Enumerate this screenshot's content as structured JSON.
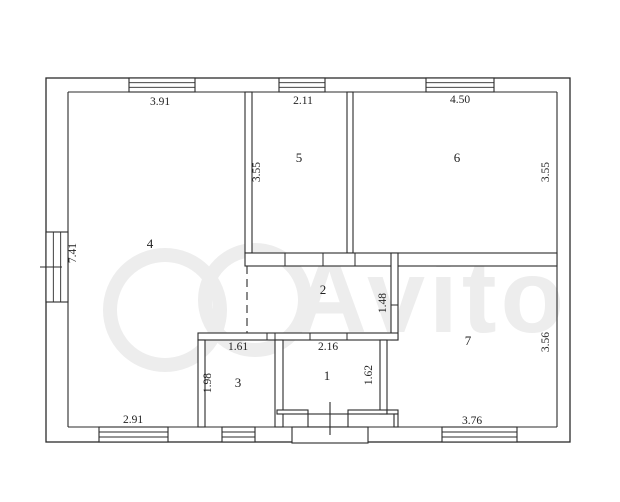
{
  "plan": {
    "canvas": {
      "width": 620,
      "height": 502
    },
    "colors": {
      "background": "#ffffff",
      "line": "#2b2b2b",
      "wall_fill": "#ffffff",
      "watermark": "#ededed"
    },
    "watermark": {
      "text": "Avito",
      "text_x": 430,
      "text_y": 332,
      "circles": [
        {
          "cx": 165,
          "cy": 310,
          "r": 55
        },
        {
          "cx": 255,
          "cy": 300,
          "r": 50
        }
      ]
    },
    "outer": {
      "x": 46,
      "y": 78,
      "w": 524,
      "h": 364,
      "inner": {
        "left": 68,
        "top": 92,
        "right": 557,
        "bottom": 427
      }
    },
    "interior_walls": [
      {
        "name": "wall-room4-room5",
        "x": 245,
        "y": 92,
        "w": 7,
        "h": 161
      },
      {
        "name": "wall-room5-room6",
        "x": 347,
        "y": 92,
        "w": 6,
        "h": 161
      },
      {
        "name": "wall-corridor-top",
        "x": 245,
        "y": 253,
        "w": 312,
        "h": 13
      },
      {
        "name": "wall-corridor-right",
        "x": 391,
        "y": 253,
        "w": 7,
        "h": 87
      },
      {
        "name": "wall-rooms31-top",
        "x": 198,
        "y": 333,
        "w": 200,
        "h": 7
      },
      {
        "name": "wall-room3-left",
        "x": 198,
        "y": 340,
        "w": 7,
        "h": 87
      },
      {
        "name": "wall-room3-room1",
        "x": 275,
        "y": 340,
        "w": 8,
        "h": 87
      },
      {
        "name": "wall-room1-right",
        "x": 380,
        "y": 340,
        "w": 7,
        "h": 74
      },
      {
        "name": "wall-room1-bottom-l",
        "x": 277,
        "y": 410,
        "w": 31,
        "h": 4
      },
      {
        "name": "wall-room1-bottom-r",
        "x": 348,
        "y": 410,
        "w": 39,
        "h": 4
      },
      {
        "name": "wall-step-h",
        "x": 387,
        "y": 410,
        "w": 11,
        "h": 4
      },
      {
        "name": "wall-step-v",
        "x": 394,
        "y": 414,
        "w": 4,
        "h": 13
      }
    ],
    "windows": [
      {
        "name": "window-top-room4",
        "orient": "h",
        "x": 129,
        "y": 78,
        "w": 66,
        "h": 14
      },
      {
        "name": "window-top-room5",
        "orient": "h",
        "x": 279,
        "y": 78,
        "w": 46,
        "h": 14
      },
      {
        "name": "window-top-room6",
        "orient": "h",
        "x": 426,
        "y": 78,
        "w": 68,
        "h": 14
      },
      {
        "name": "window-left-room4",
        "orient": "v",
        "x": 46,
        "y": 232,
        "w": 22,
        "h": 70
      },
      {
        "name": "window-bottom-room4",
        "orient": "h",
        "x": 99,
        "y": 427,
        "w": 69,
        "h": 15
      },
      {
        "name": "window-bottom-room3",
        "orient": "h",
        "x": 222,
        "y": 427,
        "w": 33,
        "h": 15
      },
      {
        "name": "window-bottom-room7",
        "orient": "h",
        "x": 442,
        "y": 427,
        "w": 75,
        "h": 15
      }
    ],
    "door_ticks": [
      {
        "x1": 285,
        "y1": 253,
        "x2": 285,
        "y2": 266
      },
      {
        "x1": 323,
        "y1": 253,
        "x2": 323,
        "y2": 266
      },
      {
        "x1": 355,
        "y1": 253,
        "x2": 355,
        "y2": 266
      },
      {
        "x1": 267,
        "y1": 333,
        "x2": 267,
        "y2": 340
      },
      {
        "x1": 275,
        "y1": 333,
        "x2": 275,
        "y2": 340
      },
      {
        "x1": 310,
        "y1": 333,
        "x2": 310,
        "y2": 340
      },
      {
        "x1": 347,
        "y1": 333,
        "x2": 347,
        "y2": 340
      },
      {
        "x1": 391,
        "y1": 305,
        "x2": 398,
        "y2": 305
      },
      {
        "x1": 40,
        "y1": 267,
        "x2": 62,
        "y2": 267
      }
    ],
    "open_boundary": {
      "x": 247,
      "y1": 266,
      "y2": 333
    },
    "entrance": {
      "threshold": {
        "x": 308,
        "y": 414,
        "w": 40,
        "h": 13
      },
      "porch": {
        "x": 292,
        "y": 427,
        "w": 76,
        "h": 16
      },
      "door_line": {
        "x1": 330,
        "y1": 402,
        "x2": 330,
        "y2": 435
      }
    },
    "rooms": [
      {
        "number": "4",
        "x": 150,
        "y": 248
      },
      {
        "number": "5",
        "x": 299,
        "y": 162
      },
      {
        "number": "6",
        "x": 457,
        "y": 162
      },
      {
        "number": "2",
        "x": 323,
        "y": 294
      },
      {
        "number": "3",
        "x": 238,
        "y": 387
      },
      {
        "number": "1",
        "x": 327,
        "y": 380
      },
      {
        "number": "7",
        "x": 468,
        "y": 345
      }
    ],
    "dimensions": [
      {
        "value": "3.91",
        "x": 160,
        "y": 105,
        "rotated": false
      },
      {
        "value": "2.11",
        "x": 303,
        "y": 104,
        "rotated": false
      },
      {
        "value": "4.50",
        "x": 460,
        "y": 103,
        "rotated": false
      },
      {
        "value": "3.55",
        "x": 260,
        "y": 172,
        "rotated": true
      },
      {
        "value": "3.55",
        "x": 549,
        "y": 172,
        "rotated": true
      },
      {
        "value": "7.41",
        "x": 76,
        "y": 253,
        "rotated": true
      },
      {
        "value": "1.48",
        "x": 386,
        "y": 303,
        "rotated": true
      },
      {
        "value": "1.61",
        "x": 238,
        "y": 350,
        "rotated": false
      },
      {
        "value": "2.16",
        "x": 328,
        "y": 350,
        "rotated": false
      },
      {
        "value": "1.98",
        "x": 211,
        "y": 383,
        "rotated": true
      },
      {
        "value": "1.62",
        "x": 372,
        "y": 375,
        "rotated": true
      },
      {
        "value": "3.56",
        "x": 549,
        "y": 342,
        "rotated": true
      },
      {
        "value": "2.91",
        "x": 133,
        "y": 423,
        "rotated": false
      },
      {
        "value": "3.76",
        "x": 472,
        "y": 424,
        "rotated": false
      }
    ]
  }
}
